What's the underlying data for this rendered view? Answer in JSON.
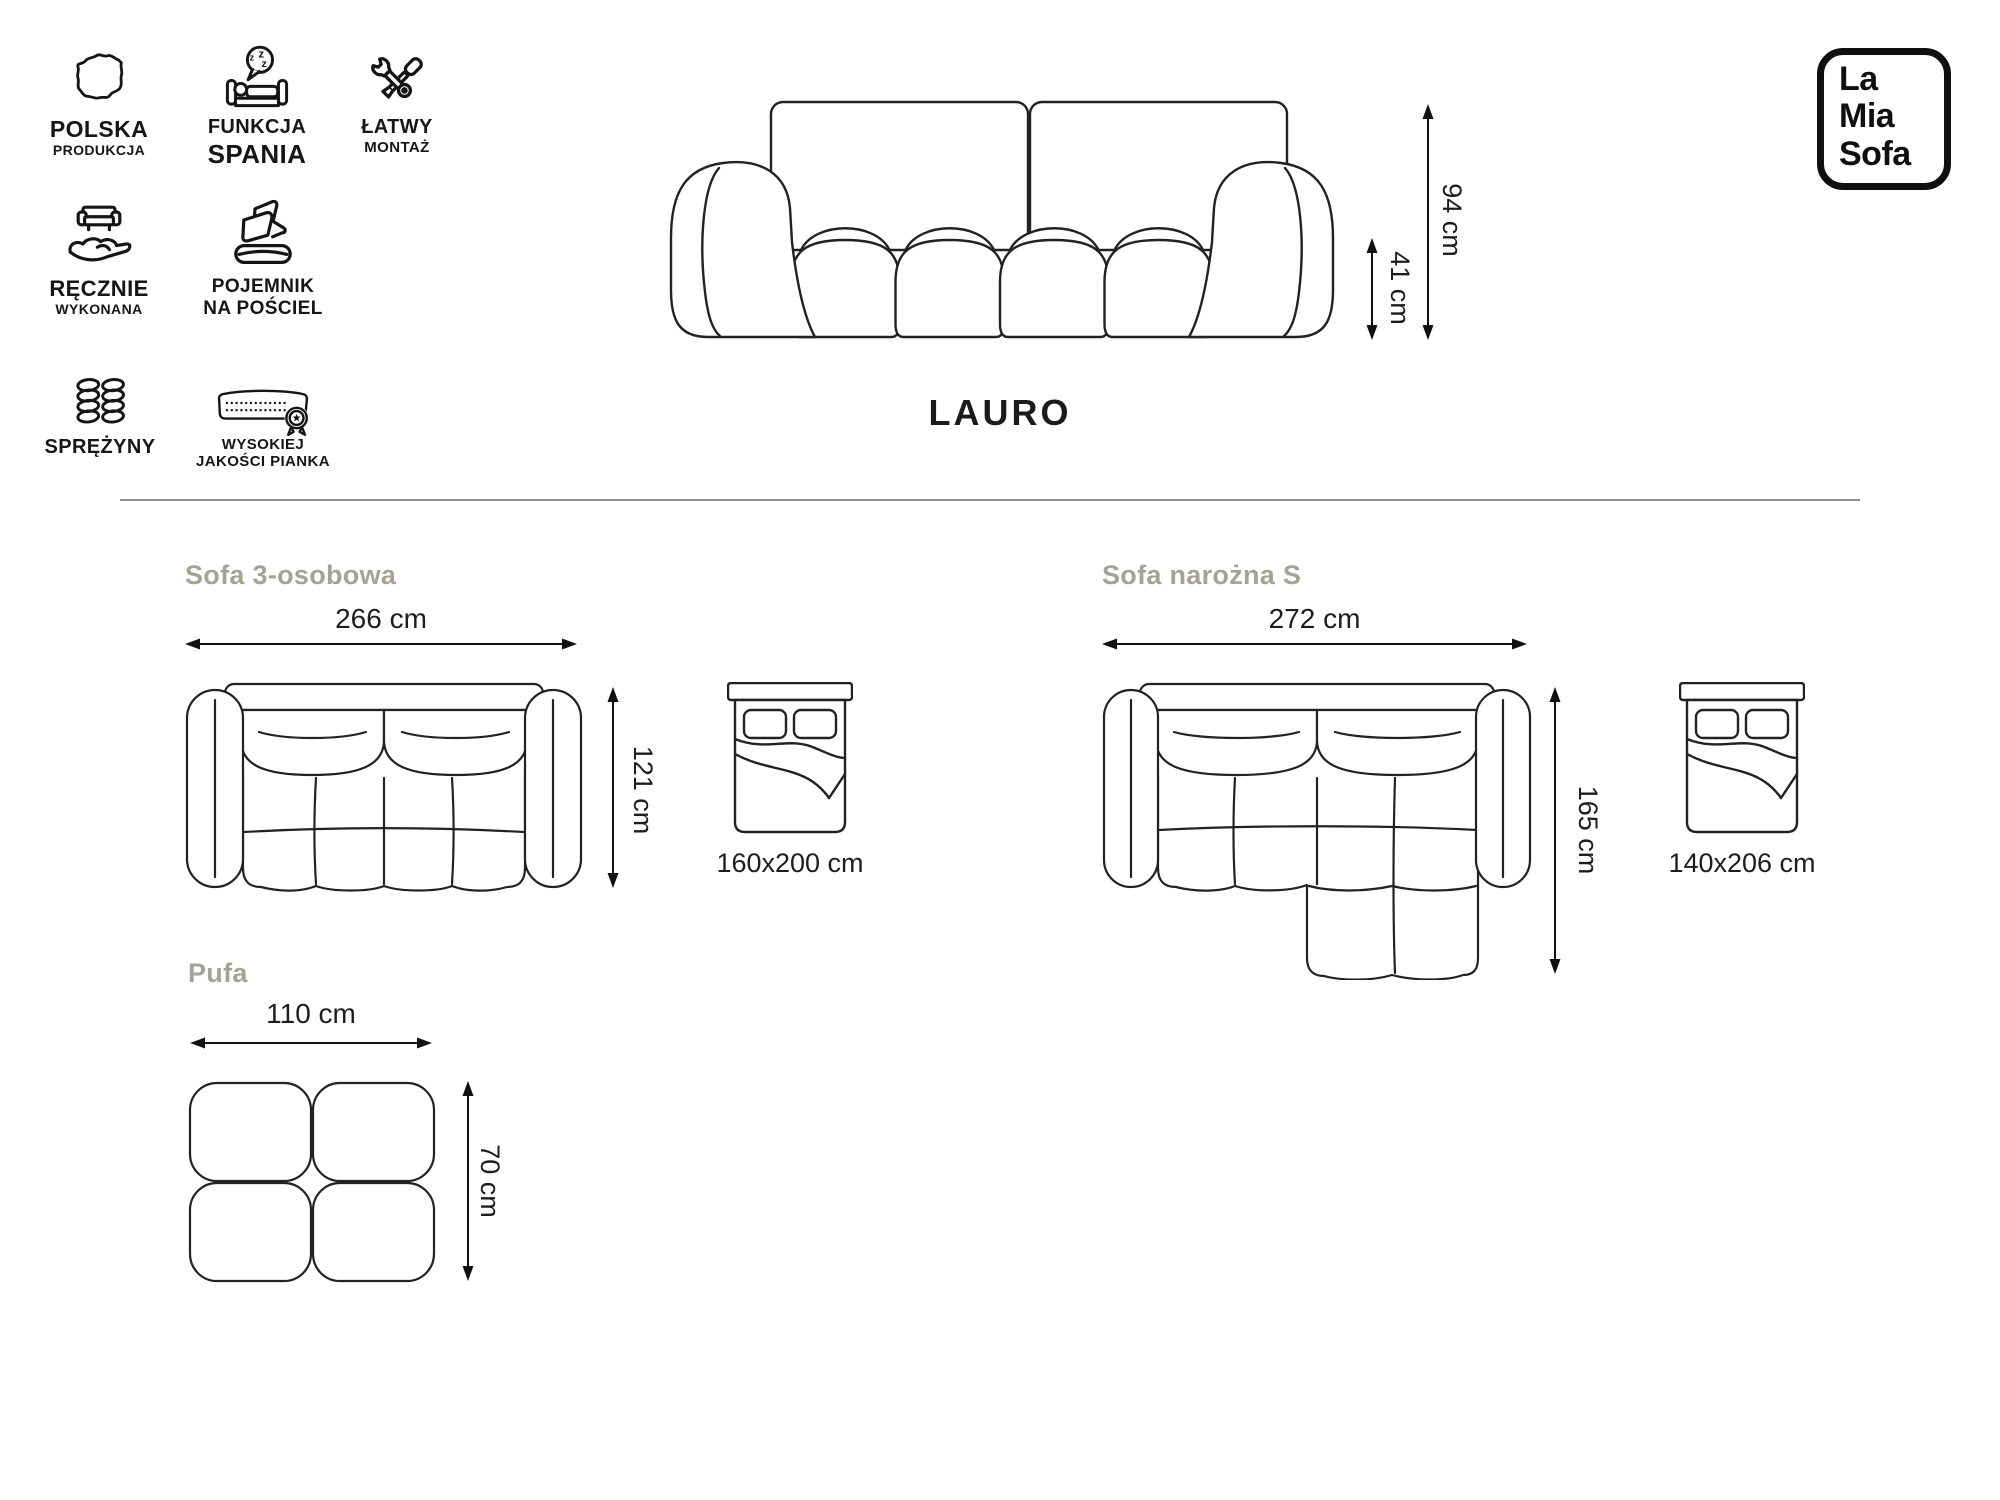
{
  "brand": {
    "logo_lines": [
      "La",
      "Mia",
      "Sofa"
    ]
  },
  "product": {
    "name": "LAURO"
  },
  "features": [
    {
      "icon": "poland-map-icon",
      "line1": "POLSKA",
      "line2": "PRODUKCJA"
    },
    {
      "icon": "sleep-function-icon",
      "line1": "FUNKCJA",
      "line2": "SPANIA"
    },
    {
      "icon": "assembly-tools-icon",
      "line1": "ŁATWY",
      "line2": "MONTAŻ"
    },
    {
      "icon": "handmade-icon",
      "line1": "RĘCZNIE",
      "line2": "WYKONANA"
    },
    {
      "icon": "bedding-storage-icon",
      "line1": "POJEMNIK",
      "line2": "NA POŚCIEL"
    },
    {
      "icon": "springs-icon",
      "line1": "SPRĘŻYNY",
      "line2": ""
    },
    {
      "icon": "quality-foam-icon",
      "line1": "WYSOKIEJ",
      "line2": "JAKOŚCI PIANKA"
    }
  ],
  "front_view": {
    "total_height": "94 cm",
    "seat_height": "41 cm"
  },
  "variants": [
    {
      "title": "Sofa 3-osobowa",
      "width": "266 cm",
      "depth": "121 cm",
      "sleeping_area": "160x200 cm"
    },
    {
      "title": "Sofa narożna S",
      "width": "272 cm",
      "depth": "165 cm",
      "sleeping_area": "140x206 cm"
    },
    {
      "title": "Pufa",
      "width": "110 cm",
      "depth": "70 cm"
    }
  ],
  "colors": {
    "line_art": "#222222",
    "heading": "#a5a296",
    "divider": "#8f8f8f",
    "text": "#1d1d1d"
  }
}
